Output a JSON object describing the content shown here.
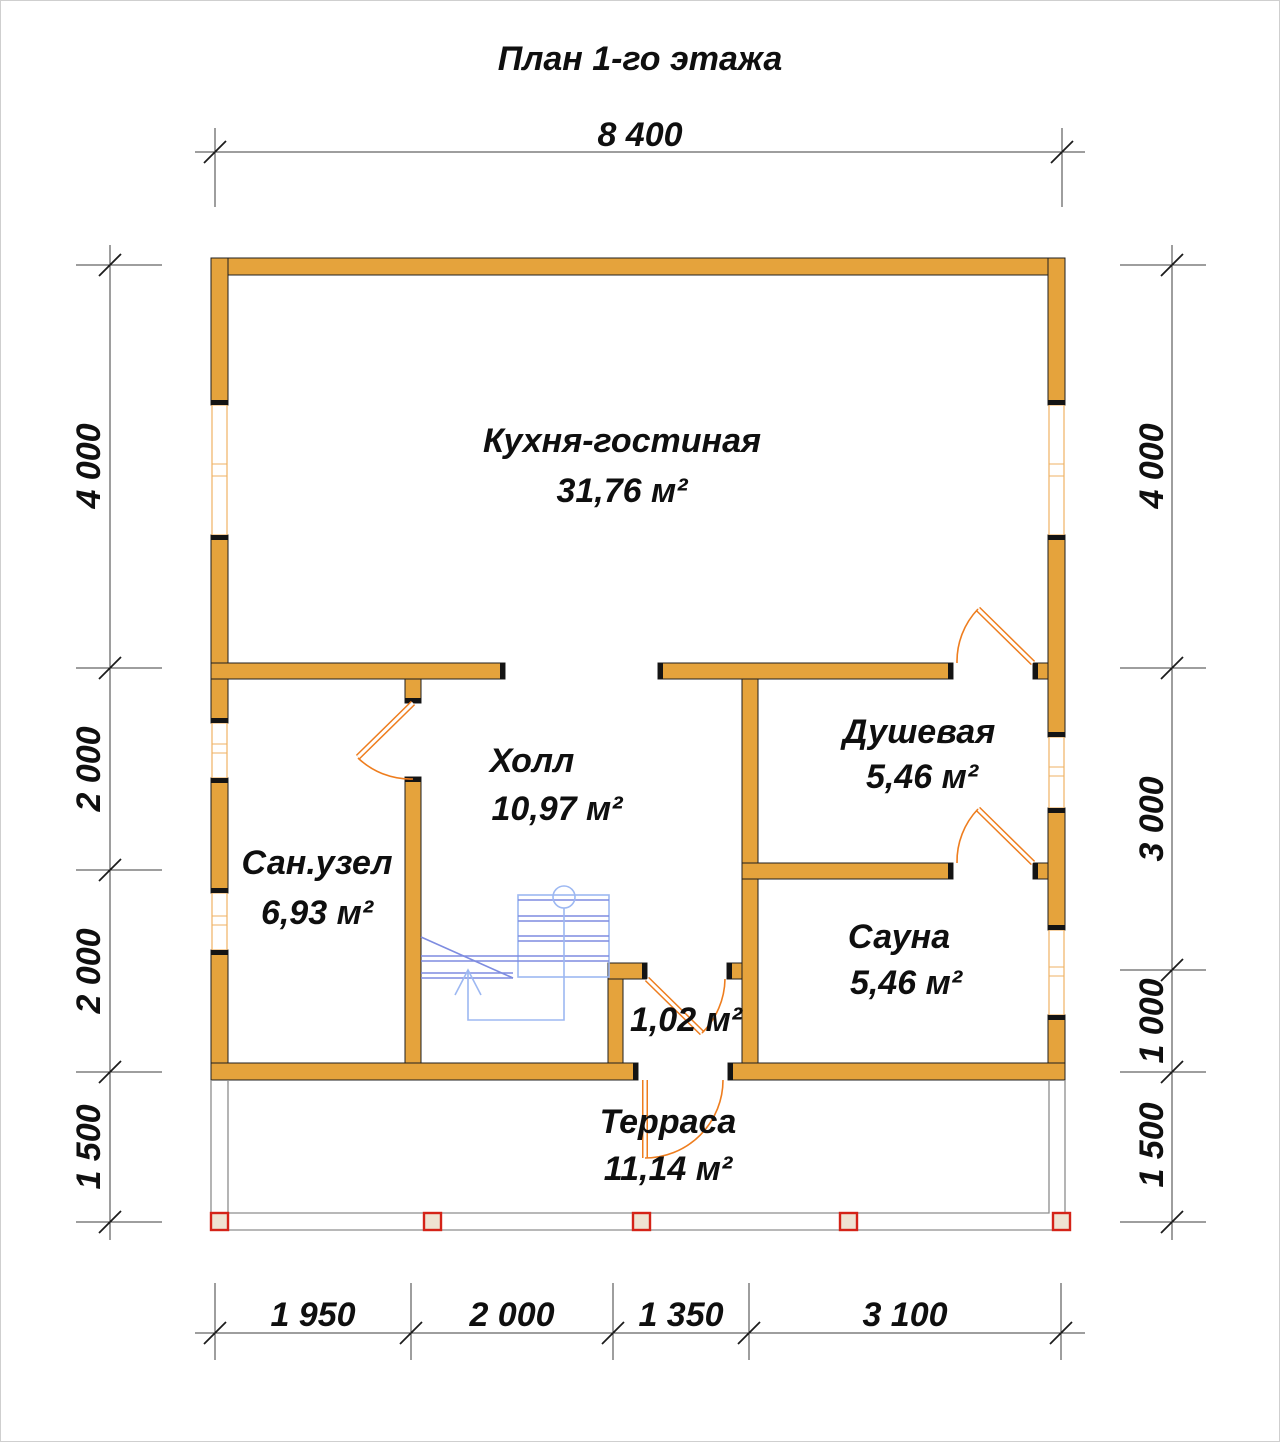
{
  "title": "План 1-го этажа",
  "rooms": {
    "kitchen_living": {
      "name": "Кухня-гостиная",
      "area": "31,76 м²"
    },
    "hall": {
      "name": "Холл",
      "area": "10,97 м²"
    },
    "bathroom": {
      "name": "Сан.узел",
      "area": "6,93 м²"
    },
    "shower": {
      "name": "Душевая",
      "area": "5,46 м²"
    },
    "sauna": {
      "name": "Сауна",
      "area": "5,46 м²"
    },
    "closet": {
      "area": "1,02 м²"
    },
    "terrace": {
      "name": "Терраса",
      "area": "11,14 м²"
    }
  },
  "dimensions": {
    "top": [
      "8 400"
    ],
    "bottom": [
      "1 950",
      "2 000",
      "1 350",
      "3 100"
    ],
    "left": [
      "4 000",
      "2 000",
      "2 000",
      "1 500"
    ],
    "right": [
      "4 000",
      "3 000",
      "1 000",
      "1 500"
    ]
  },
  "colors": {
    "wall_fill": "#E5A33C",
    "door": "#EE7D1E",
    "window_frame": "#EFB263",
    "stairs": "#7E8CE0",
    "terrace_post": "#D42318"
  }
}
